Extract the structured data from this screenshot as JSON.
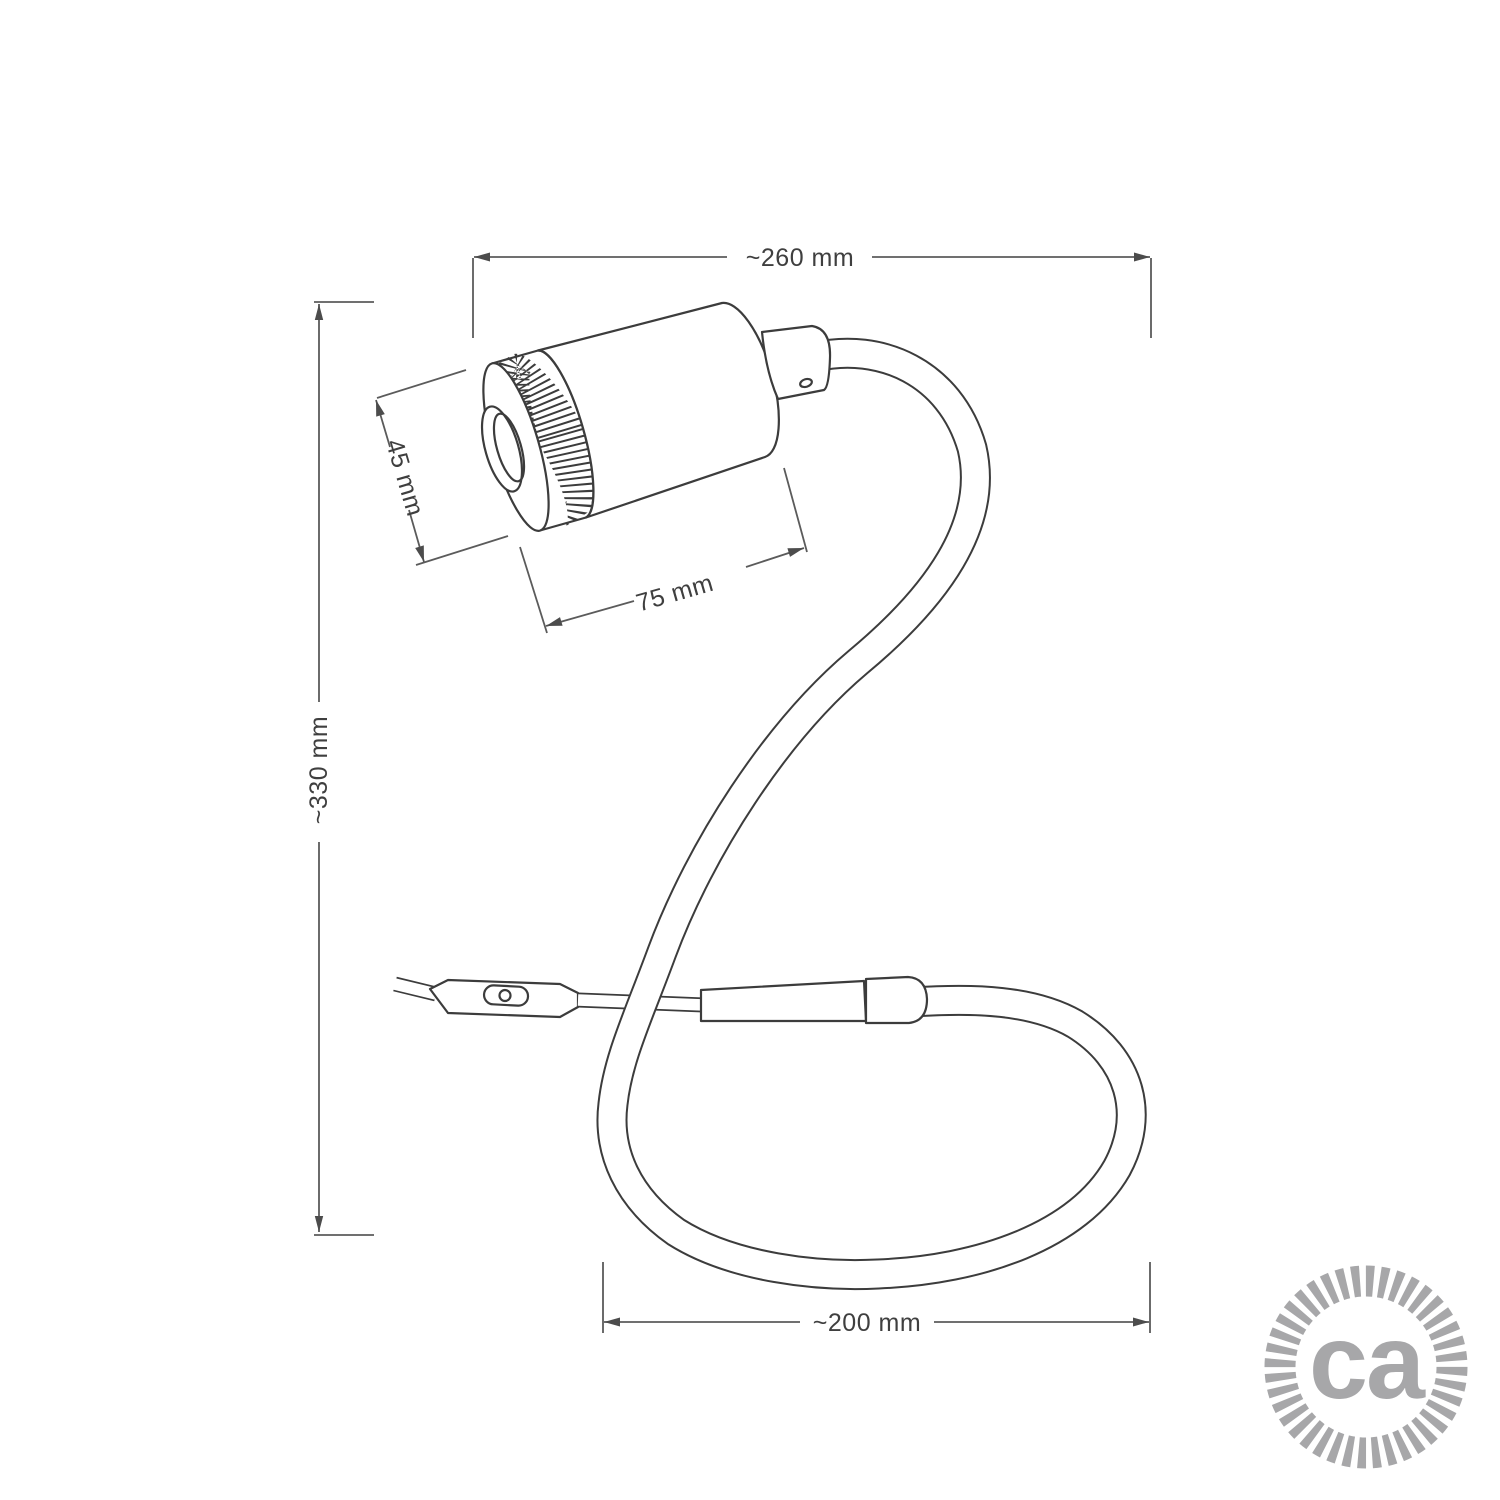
{
  "dimensions": {
    "total_width": "~260 mm",
    "total_height": "~330 mm",
    "spot_diameter": "45 mm",
    "spot_length": "75 mm",
    "base_loop_width": "~200 mm"
  },
  "logo": {
    "text": "ca",
    "color": "#a7a7a9"
  },
  "colors": {
    "outline": "#3c3c3c",
    "dimension_line": "#5b5b5b",
    "label_text": "#3f3f3f",
    "background": "#ffffff"
  }
}
